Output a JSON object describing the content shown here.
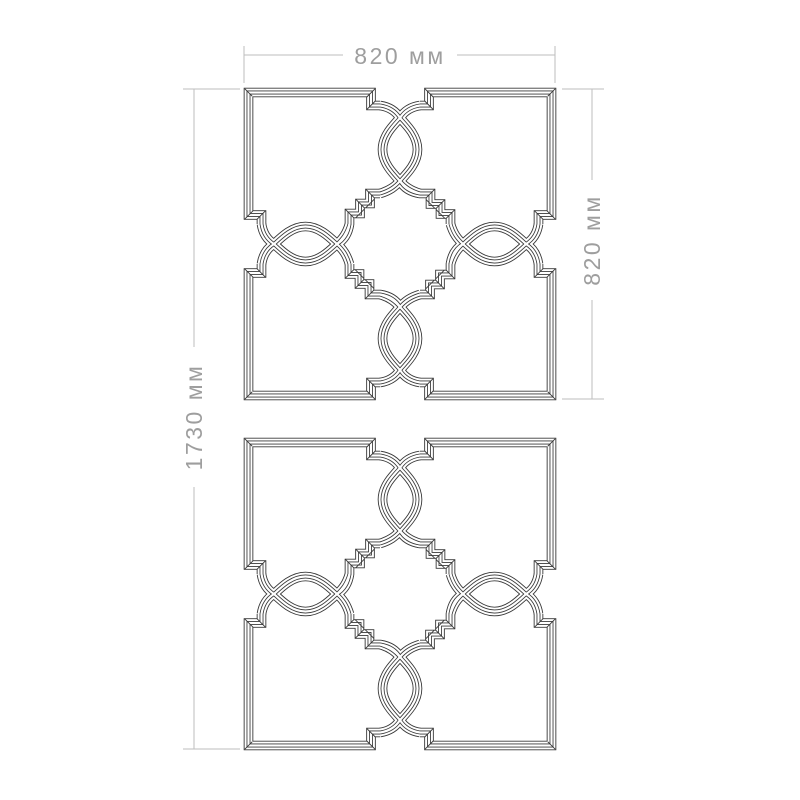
{
  "page": {
    "background": "#ffffff"
  },
  "drawing": {
    "panels": {
      "count": 2
    },
    "dimensions": {
      "top_width": "820 мм",
      "right_height": "820 мм",
      "left_total_height": "1730 мм"
    },
    "colors": {
      "ornament_line": "#383838",
      "dimension_line": "#bdbdbd",
      "dimension_text": "#9e9e9e"
    }
  }
}
